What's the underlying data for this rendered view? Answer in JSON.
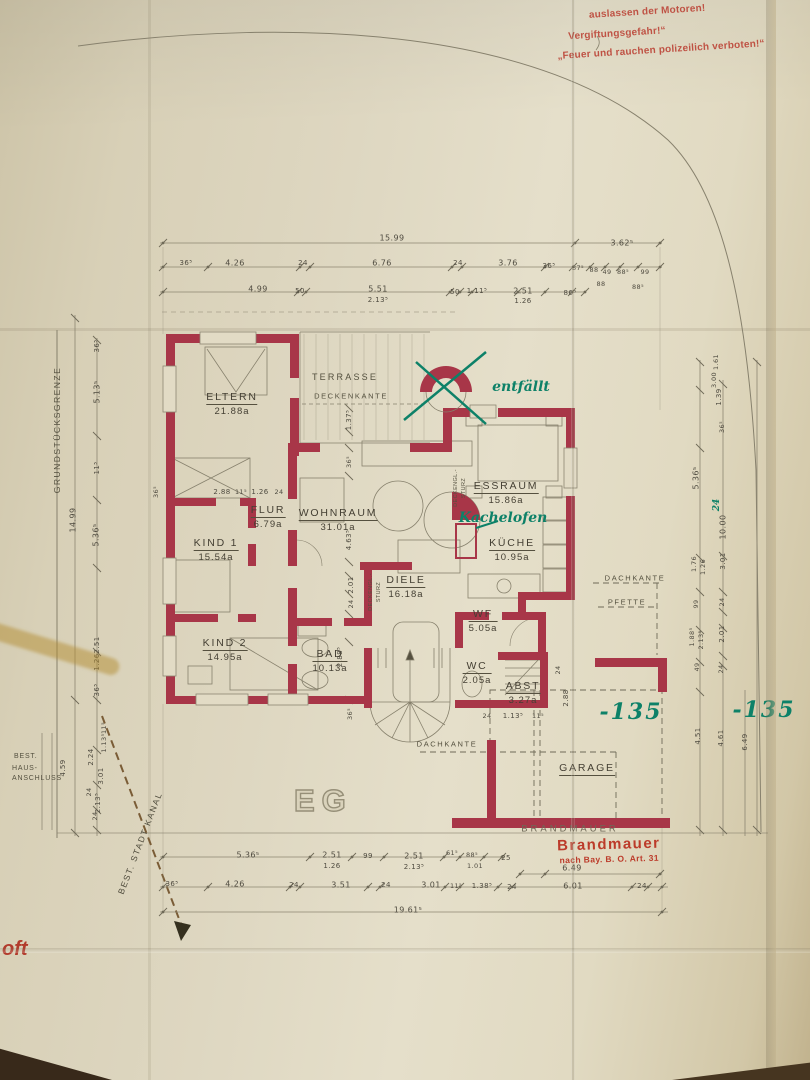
{
  "colors": {
    "paper": "#ded7c1",
    "wall_red": "#a83648",
    "pencil": "#54503f",
    "green_ink": "#0d8168",
    "stamp_red": "#bc3b2a",
    "warning_red": "#bf5244"
  },
  "floor_label": "EG",
  "warnings": {
    "line1": "auslassen der Motoren!",
    "line2": "Vergiftungsgefahr!“",
    "line3": "„Feuer und rauchen polizeilich verboten!“"
  },
  "stamp": {
    "line1": "Brandmauer",
    "line2": "nach Bay. B. O. Art. 31"
  },
  "site": {
    "boundary": "GRUNDSTÜCKSGRENZE",
    "kanal": "BEST. STADT KANAL",
    "best": "BEST.",
    "haus1": "HAUS-",
    "haus2": "ANSCHLUSS",
    "fragment": "oft"
  },
  "rooms": [
    {
      "id": "eltern",
      "name": "ELTERN",
      "area": "21.88a",
      "x": 232,
      "y": 404
    },
    {
      "id": "kind1",
      "name": "KIND 1",
      "area": "15.54a",
      "x": 216,
      "y": 550
    },
    {
      "id": "kind2",
      "name": "KIND 2",
      "area": "14.95a",
      "x": 225,
      "y": 650
    },
    {
      "id": "flur",
      "name": "FLUR",
      "area": "6.79a",
      "x": 268,
      "y": 517
    },
    {
      "id": "wohnraum",
      "name": "WOHNRAUM",
      "area": "31.01a",
      "x": 338,
      "y": 520
    },
    {
      "id": "essraum",
      "name": "ESSRAUM",
      "area": "15.86a",
      "x": 506,
      "y": 493
    },
    {
      "id": "kueche",
      "name": "KÜCHE",
      "area": "10.95a",
      "x": 512,
      "y": 550
    },
    {
      "id": "diele",
      "name": "DIELE",
      "area": "16.18a",
      "x": 406,
      "y": 587
    },
    {
      "id": "wf",
      "name": "WF",
      "area": "5.05a",
      "x": 483,
      "y": 621
    },
    {
      "id": "bad",
      "name": "BAD",
      "area": "10.13a",
      "x": 330,
      "y": 661
    },
    {
      "id": "wc",
      "name": "WC",
      "area": "2.05a",
      "x": 477,
      "y": 673
    },
    {
      "id": "abst",
      "name": "ABST",
      "area": "3.27a",
      "x": 523,
      "y": 693
    },
    {
      "id": "garage",
      "name": "GARAGE",
      "area": "",
      "x": 587,
      "y": 769
    }
  ],
  "plan_labels": [
    {
      "t": "TERRASSE",
      "x": 345,
      "y": 377
    },
    {
      "t": "DECKENKANTE",
      "x": 351,
      "y": 396,
      "cls": "tiny"
    },
    {
      "t": "DACHKANTE",
      "x": 635,
      "y": 578,
      "cls": "tiny"
    },
    {
      "t": "PFETTE",
      "x": 627,
      "y": 602,
      "cls": "tiny"
    },
    {
      "t": "DACHKANTE",
      "x": 447,
      "y": 744,
      "cls": "tiny"
    },
    {
      "t": "BRANDMAUER",
      "x": 570,
      "y": 829,
      "cls": "pencilname"
    },
    {
      "t": "DECKENGL.-",
      "x": 456,
      "y": 488,
      "r": -90,
      "cls": "micro"
    },
    {
      "t": "STURZ",
      "x": 464,
      "y": 488,
      "r": -90,
      "cls": "micro"
    },
    {
      "t": "DECKENGL.-",
      "x": 371,
      "y": 592,
      "r": -90,
      "cls": "micro"
    },
    {
      "t": "STURZ",
      "x": 379,
      "y": 592,
      "r": -90,
      "cls": "micro"
    }
  ],
  "green_notes": [
    {
      "t": "entfällt",
      "x": 521,
      "y": 387,
      "cls": "hand"
    },
    {
      "t": "Kachelofen",
      "x": 503,
      "y": 518,
      "cls": "hand"
    },
    {
      "t": "-135",
      "x": 631,
      "y": 712,
      "cls": "big"
    },
    {
      "t": "-135",
      "x": 764,
      "y": 710,
      "cls": "big"
    },
    {
      "t": "24",
      "x": 717,
      "y": 505,
      "r": -90,
      "cls": "small"
    }
  ],
  "dim_labels": [
    {
      "t": "15.99",
      "x": 392,
      "y": 238
    },
    {
      "t": "3.62⁵",
      "x": 622,
      "y": 243
    },
    {
      "t": "36⁵",
      "x": 186,
      "y": 263,
      "s": 7
    },
    {
      "t": "4.26",
      "x": 235,
      "y": 263
    },
    {
      "t": "24",
      "x": 303,
      "y": 263,
      "s": 7
    },
    {
      "t": "6.76",
      "x": 382,
      "y": 263
    },
    {
      "t": "24",
      "x": 458,
      "y": 263,
      "s": 7
    },
    {
      "t": "3.76",
      "x": 508,
      "y": 263
    },
    {
      "t": "36⁵",
      "x": 549,
      "y": 266,
      "s": 7
    },
    {
      "t": "37⁵",
      "x": 578,
      "y": 268,
      "s": 6.5
    },
    {
      "t": "88",
      "x": 594,
      "y": 270,
      "s": 6.5
    },
    {
      "t": "49",
      "x": 607,
      "y": 272,
      "s": 6.5
    },
    {
      "t": "88⁵",
      "x": 623,
      "y": 272,
      "s": 6.5
    },
    {
      "t": "99",
      "x": 645,
      "y": 272,
      "s": 6.5
    },
    {
      "t": "88",
      "x": 601,
      "y": 284,
      "s": 6.5
    },
    {
      "t": "88⁵",
      "x": 638,
      "y": 287,
      "s": 6.5
    },
    {
      "t": "4.99",
      "x": 258,
      "y": 289
    },
    {
      "t": "50",
      "x": 300,
      "y": 291,
      "s": 7
    },
    {
      "t": "5.51",
      "x": 378,
      "y": 289
    },
    {
      "t": "2.13⁵",
      "x": 378,
      "y": 300,
      "s": 7
    },
    {
      "t": "50",
      "x": 455,
      "y": 292,
      "s": 7
    },
    {
      "t": "1.11⁵",
      "x": 477,
      "y": 291,
      "s": 7
    },
    {
      "t": "2.51",
      "x": 523,
      "y": 291
    },
    {
      "t": "1.26",
      "x": 523,
      "y": 301,
      "s": 7
    },
    {
      "t": "86⁵",
      "x": 570,
      "y": 293,
      "s": 7
    },
    {
      "t": "5.36⁵",
      "x": 248,
      "y": 855
    },
    {
      "t": "2.51",
      "x": 332,
      "y": 855
    },
    {
      "t": "1.26",
      "x": 332,
      "y": 866,
      "s": 7
    },
    {
      "t": "99",
      "x": 368,
      "y": 856,
      "s": 7
    },
    {
      "t": "2.51",
      "x": 414,
      "y": 856
    },
    {
      "t": "2.13⁵",
      "x": 414,
      "y": 867,
      "s": 7
    },
    {
      "t": "61⁵",
      "x": 452,
      "y": 853,
      "s": 6.5
    },
    {
      "t": "88⁵",
      "x": 472,
      "y": 855,
      "s": 6.5
    },
    {
      "t": "1.01",
      "x": 475,
      "y": 866,
      "s": 6.5
    },
    {
      "t": "25",
      "x": 506,
      "y": 858,
      "s": 7
    },
    {
      "t": "6.49",
      "x": 572,
      "y": 868
    },
    {
      "t": "36⁵",
      "x": 172,
      "y": 884,
      "s": 7
    },
    {
      "t": "4.26",
      "x": 235,
      "y": 884
    },
    {
      "t": "24",
      "x": 294,
      "y": 885,
      "s": 7
    },
    {
      "t": "3.51",
      "x": 341,
      "y": 885
    },
    {
      "t": "24",
      "x": 386,
      "y": 885,
      "s": 7
    },
    {
      "t": "3.01",
      "x": 431,
      "y": 885
    },
    {
      "t": "11⁵",
      "x": 456,
      "y": 886,
      "s": 6.5
    },
    {
      "t": "1.38⁵",
      "x": 482,
      "y": 886,
      "s": 7
    },
    {
      "t": "24",
      "x": 512,
      "y": 887,
      "s": 7
    },
    {
      "t": "6.01",
      "x": 573,
      "y": 886
    },
    {
      "t": "24",
      "x": 642,
      "y": 886,
      "s": 7
    },
    {
      "t": "19.61⁵",
      "x": 408,
      "y": 910
    },
    {
      "t": "36⁵",
      "x": 97,
      "y": 346,
      "r": -90,
      "s": 7
    },
    {
      "t": "5.13⁵",
      "x": 97,
      "y": 392,
      "r": -90
    },
    {
      "t": "11⁵",
      "x": 97,
      "y": 468,
      "r": -90,
      "s": 7
    },
    {
      "t": "5.36⁵",
      "x": 96,
      "y": 535,
      "r": -90
    },
    {
      "t": "14.99",
      "x": 73,
      "y": 520,
      "r": -90
    },
    {
      "t": "2.51",
      "x": 97,
      "y": 645,
      "r": -90,
      "s": 7
    },
    {
      "t": "1.26",
      "x": 97,
      "y": 662,
      "r": -90,
      "s": 7
    },
    {
      "t": "36⁵",
      "x": 97,
      "y": 690,
      "r": -90,
      "s": 7
    },
    {
      "t": "11⁵",
      "x": 104,
      "y": 728,
      "r": -90,
      "s": 6.5
    },
    {
      "t": "1.13⁵",
      "x": 104,
      "y": 743,
      "r": -90,
      "s": 6.5
    },
    {
      "t": "2.24",
      "x": 91,
      "y": 757,
      "r": -90,
      "s": 7
    },
    {
      "t": "3.01",
      "x": 101,
      "y": 776,
      "r": -90,
      "s": 7
    },
    {
      "t": "24",
      "x": 89,
      "y": 792,
      "r": -90,
      "s": 6.5
    },
    {
      "t": "2.13⁵",
      "x": 98,
      "y": 803,
      "r": -90,
      "s": 7
    },
    {
      "t": "24",
      "x": 95,
      "y": 816,
      "r": -90,
      "s": 6.5
    },
    {
      "t": "4.59",
      "x": 63,
      "y": 768,
      "r": -90,
      "s": 7
    },
    {
      "t": "1.61",
      "x": 716,
      "y": 362,
      "r": -90,
      "s": 6.5
    },
    {
      "t": "3.00",
      "x": 714,
      "y": 380,
      "r": -90,
      "s": 6.5
    },
    {
      "t": "1.39",
      "x": 719,
      "y": 397,
      "r": -90,
      "s": 7
    },
    {
      "t": "36⁵",
      "x": 722,
      "y": 427,
      "r": -90,
      "s": 6.5
    },
    {
      "t": "5.36⁵",
      "x": 696,
      "y": 478,
      "r": -90
    },
    {
      "t": "10.00",
      "x": 723,
      "y": 527,
      "r": -90
    },
    {
      "t": "1.76",
      "x": 694,
      "y": 564,
      "r": -90,
      "s": 6.5
    },
    {
      "t": "1.26",
      "x": 703,
      "y": 567,
      "r": -90,
      "s": 6.5
    },
    {
      "t": "3.01",
      "x": 723,
      "y": 561,
      "r": -90,
      "s": 7
    },
    {
      "t": "99",
      "x": 696,
      "y": 604,
      "r": -90,
      "s": 6.5
    },
    {
      "t": "24",
      "x": 722,
      "y": 602,
      "r": -90,
      "s": 6.5
    },
    {
      "t": "1.88⁵",
      "x": 692,
      "y": 637,
      "r": -90,
      "s": 6.5
    },
    {
      "t": "2.13⁵",
      "x": 701,
      "y": 640,
      "r": -90,
      "s": 6.5
    },
    {
      "t": "2.01",
      "x": 722,
      "y": 634,
      "r": -90,
      "s": 7
    },
    {
      "t": "49",
      "x": 697,
      "y": 667,
      "r": -90,
      "s": 6.5
    },
    {
      "t": "24",
      "x": 721,
      "y": 669,
      "r": -90,
      "s": 6.5
    },
    {
      "t": "4.51",
      "x": 698,
      "y": 736,
      "r": -90,
      "s": 7
    },
    {
      "t": "4.61",
      "x": 721,
      "y": 738,
      "r": -90,
      "s": 7
    },
    {
      "t": "6.49",
      "x": 745,
      "y": 742,
      "r": -90,
      "s": 7
    },
    {
      "t": "1.37⁵",
      "x": 349,
      "y": 420,
      "r": -90,
      "s": 7
    },
    {
      "t": "36⁵",
      "x": 349,
      "y": 462,
      "r": -90,
      "s": 6.5
    },
    {
      "t": "4.63⁵",
      "x": 349,
      "y": 540,
      "r": -90,
      "s": 7
    },
    {
      "t": "2.01",
      "x": 351,
      "y": 585,
      "r": -90,
      "s": 7
    },
    {
      "t": "24",
      "x": 351,
      "y": 604,
      "r": -90,
      "s": 6.5
    },
    {
      "t": "2.88⁵",
      "x": 340,
      "y": 657,
      "r": -90,
      "s": 7
    },
    {
      "t": "36⁵",
      "x": 350,
      "y": 714,
      "r": -90,
      "s": 6.5
    },
    {
      "t": "2.88",
      "x": 222,
      "y": 492,
      "s": 7
    },
    {
      "t": "11⁵",
      "x": 241,
      "y": 492,
      "s": 6.5
    },
    {
      "t": "1.26",
      "x": 260,
      "y": 492,
      "s": 7
    },
    {
      "t": "24",
      "x": 279,
      "y": 492,
      "s": 6.5
    },
    {
      "t": "36⁵",
      "x": 156,
      "y": 492,
      "r": -90,
      "s": 6.5
    },
    {
      "t": "24",
      "x": 487,
      "y": 716,
      "s": 6.5
    },
    {
      "t": "1.13⁵",
      "x": 513,
      "y": 716,
      "s": 7
    },
    {
      "t": "11⁵",
      "x": 538,
      "y": 716,
      "s": 6.5
    },
    {
      "t": "2.88",
      "x": 566,
      "y": 698,
      "r": -90,
      "s": 7
    },
    {
      "t": "24",
      "x": 558,
      "y": 670,
      "r": -90,
      "s": 6.5
    }
  ]
}
